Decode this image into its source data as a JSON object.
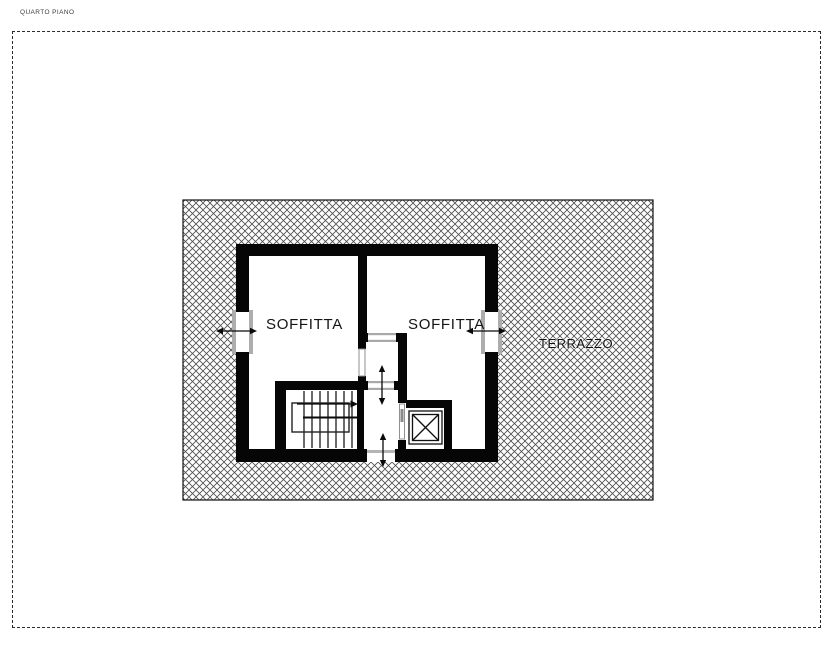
{
  "header": {
    "title": "QUARTO PIANO"
  },
  "plan": {
    "rooms": [
      {
        "label": "SOFFITTA"
      },
      {
        "label": "SOFFITTA"
      }
    ],
    "terrace": {
      "label": "TERRAZZO"
    },
    "features": [
      "terrace-hatch",
      "staircase",
      "elevator",
      "window-left",
      "window-right",
      "vestibule-doors",
      "door-to-terrace"
    ],
    "colors": {
      "wall": "#060606",
      "hatch_line": "#4d4d4d",
      "frame_gray": "#aaaaaa",
      "background": "#ffffff"
    }
  }
}
